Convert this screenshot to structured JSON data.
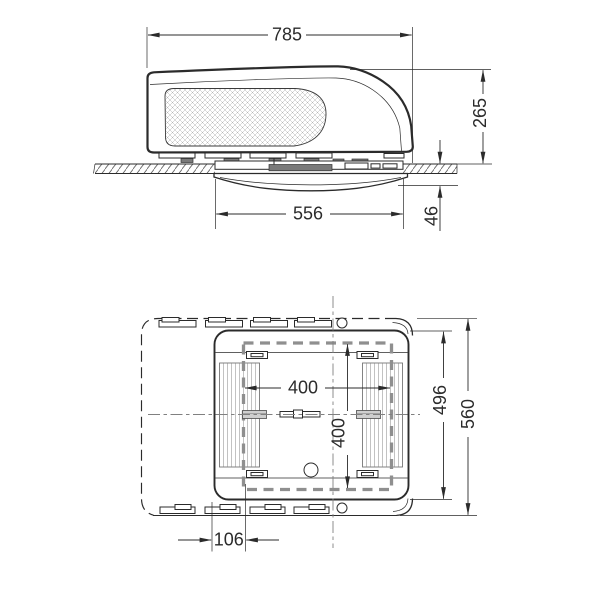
{
  "drawing": {
    "type": "technical-dimension-drawing",
    "subject": "Rooftop air conditioner unit - side elevation and bottom plan view with mounting dimensions",
    "units": "mm",
    "colors": {
      "line": "#2b2b2b",
      "cutout_dash": "#8f8f8f",
      "centerline": "#808080",
      "paper": "#ffffff"
    },
    "side_view": {
      "label": "side-elevation",
      "dimensions": {
        "total_length": "785",
        "height_above_roof": "265",
        "interior_unit_length": "556",
        "height_below_roof": "46"
      }
    },
    "plan_view": {
      "label": "bottom-plan",
      "dimensions": {
        "cutout_length": "400",
        "cutout_width": "400",
        "shroud_width": "496",
        "unit_width": "560",
        "edge_offset": "106"
      }
    }
  }
}
